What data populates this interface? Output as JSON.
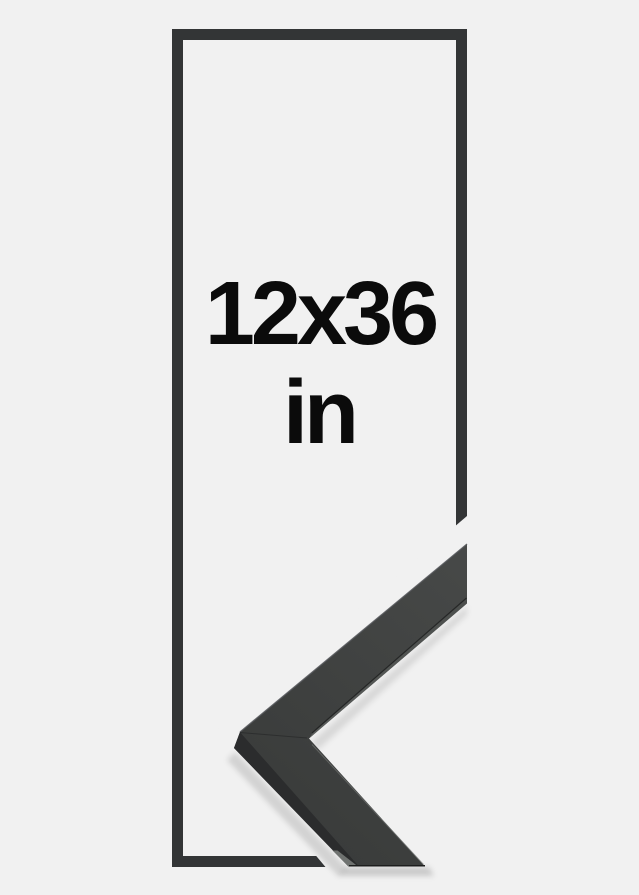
{
  "product_image": {
    "description_role": "frame-size-illustration",
    "size_label": "12x36",
    "unit_label": "in"
  },
  "colors": {
    "background": "#f1f1f1",
    "frame_outline": "#333536",
    "moulding_face_light": "#474948",
    "moulding_face_dark": "#3a3c3b",
    "moulding_side": "#2b2c2d",
    "moulding_side_sheen": "#6f7270",
    "moulding_lip_light": "#5d605e",
    "moulding_lip_dark": "#4c4f4d",
    "edge_highlight": "#54565a",
    "edge_shadow_line": "#1d1e1e",
    "text": "#0b0b0b"
  }
}
